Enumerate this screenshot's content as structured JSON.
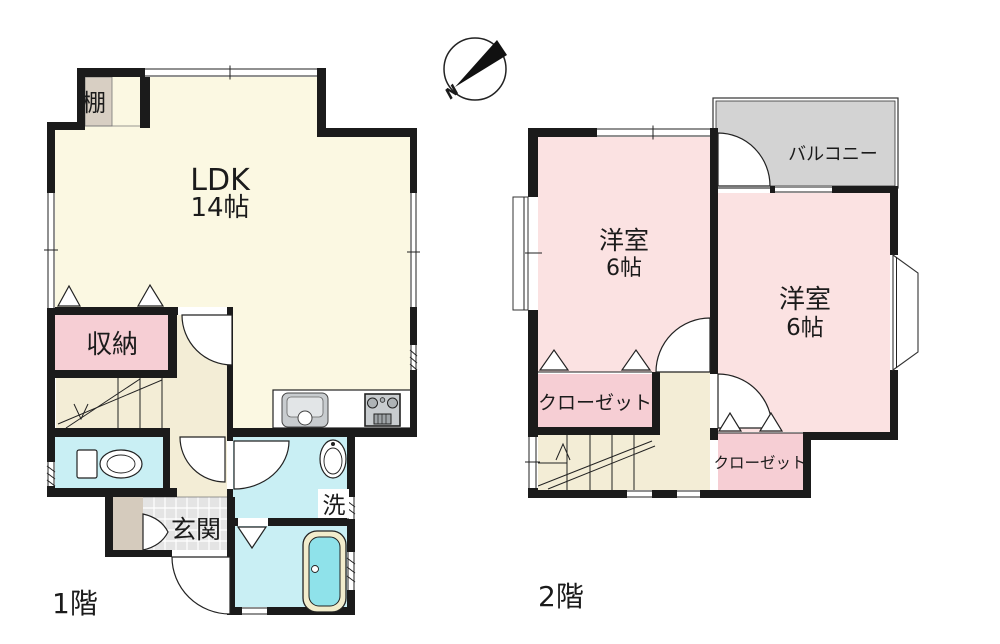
{
  "compass": {
    "north_label": "N"
  },
  "floor1": {
    "label": "1階",
    "ldk": {
      "name": "LDK",
      "size": "14帖"
    },
    "shelf": "棚",
    "storage": "収納",
    "entrance": "玄関",
    "washroom": "洗"
  },
  "floor2": {
    "label": "2階",
    "room_left": {
      "name": "洋室",
      "size": "6帖"
    },
    "room_right": {
      "name": "洋室",
      "size": "6帖"
    },
    "balcony": "バルコニー",
    "closet_left": "クローゼット",
    "closet_right": "クローゼット"
  },
  "colors": {
    "wall": "#1b1b1b",
    "line": "#222222",
    "text": "#1b1b1b",
    "ldk_floor": "#FBF8E2",
    "hall_floor": "#F3EDD6",
    "room_pink": "#FBE2E2",
    "closet_pink": "#F6CED4",
    "water_cyan": "#C9EFF4",
    "tub_cyan": "#8FE2EA",
    "tub_rim": "#F1ECCC",
    "porch_tan": "#D5CBBD",
    "shelf_tan": "#D8CFC3",
    "balcony_gray": "#D3D3D3",
    "tile_gray": "#E4E4E4",
    "fixture_gray": "#C8CCCF"
  }
}
